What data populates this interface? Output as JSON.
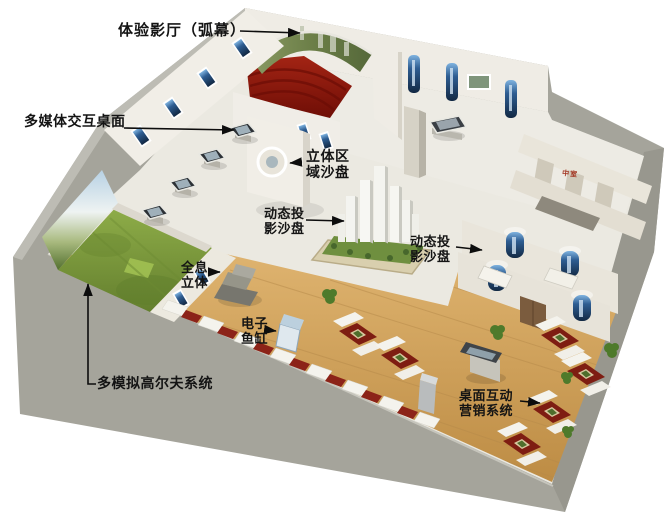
{
  "scene": {
    "type": "3d-exhibition-hall-floorplan-rendering",
    "background": "#ffffff"
  },
  "annotations": {
    "experience_theater": "体验影厅（弧幕）",
    "multimedia_interactive_table": "多媒体交互桌面",
    "stereo_area_sandbox": "立体区\n域沙盘",
    "dynamic_projection_sandbox_left": "动态投\n影沙盘",
    "dynamic_projection_sandbox_right": "动态投\n影沙盘",
    "holographic_stereo": "全息\n立体",
    "electronic_fish_tank": "电子\n鱼缸",
    "multi_golf_simulator": "多模拟高尔夫系统",
    "desktop_interactive_marketing": "桌面互动\n营销系统",
    "room_sign": "中室"
  },
  "colors": {
    "outer_wall": "#a5a49b",
    "inner_wall": "#efece5",
    "main_floor": "#ebe9e1",
    "wood_floor": "#d2a55d",
    "theater_carpet": "#8d1a10",
    "golf_grass": "#7b9a3e",
    "niche_blue": "#1c3c66",
    "sofa_red": "#7e1d12",
    "label_text": "#141414",
    "sign_red": "#a33522"
  }
}
